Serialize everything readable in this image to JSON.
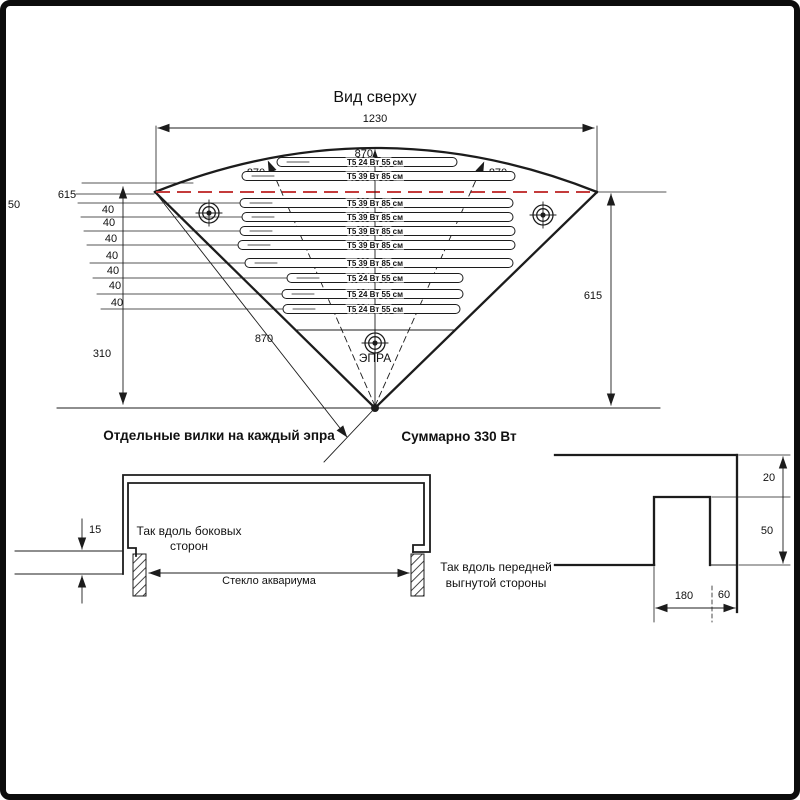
{
  "colors": {
    "line": "#1c1c1c",
    "red": "#c43b3b"
  },
  "top_view": {
    "title": "Вид сверху",
    "dims": {
      "width": "1230",
      "radius_center": "870",
      "radius_left": "870",
      "radius_right": "870",
      "radius_edge": "870",
      "depth_right": "615",
      "depth_left": "615",
      "left_50": "50",
      "left_310": "310"
    },
    "spacing": [
      "40",
      "40",
      "40",
      "40",
      "40",
      "40",
      "40"
    ],
    "lamps": [
      "Т5 24 Вт 55 см",
      "Т5 39 Вт 85 см",
      "Т5 39 Вт 85 см",
      "Т5 39 Вт 85 см",
      "Т5 39 Вт 85 см",
      "Т5 39 Вт 85 см",
      "Т5 39 Вт 85 см",
      "Т5 24 Вт 55 см",
      "Т5 24 Вт 55 см",
      "Т5 24 Вт 55 см"
    ],
    "ballast": "ЭПРА",
    "note_plugs": "Отдельные вилки на каждый эпра",
    "note_total": "Суммарно 330 Вт"
  },
  "side_section": {
    "note1": "Так вдоль боковых",
    "note2": "сторон",
    "glass": "Стекло аквариума",
    "dim_15": "15"
  },
  "front_section": {
    "note1": "Так вдоль передней",
    "note2": "выгнутой стороны",
    "dim_20": "20",
    "dim_50": "50",
    "dim_180": "180",
    "dim_60": "60"
  }
}
